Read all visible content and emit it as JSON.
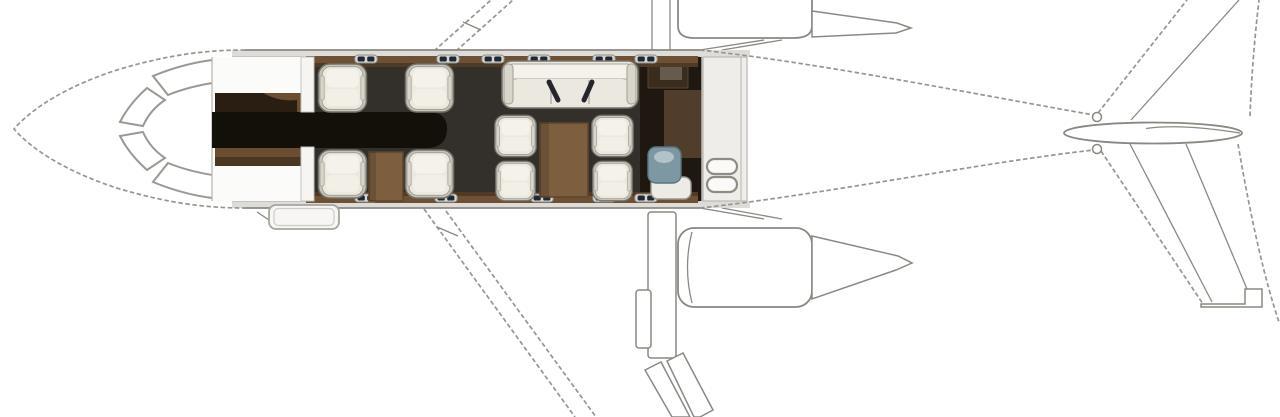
{
  "figure": {
    "kind": "business-jet-cabin-floorplan",
    "view": "top-down",
    "orientation": "nose-left-tail-right"
  },
  "aircraft": {
    "windshield_panels": 4,
    "engines": 2,
    "engine_mount": "rear-fuselage",
    "tail_type": "t-tail",
    "entry_door": "forward lower-edge airstair door",
    "cabin_windows_upper_row": 6,
    "cabin_windows_lower_row": 5,
    "seating": {
      "forward_club_seats": 4,
      "divan_seats": 3,
      "aft_conference_seats": 4,
      "total_passenger_seats": 11,
      "tables": 2
    },
    "zones": [
      "cockpit",
      "forward-entry-and-galley",
      "forward-club-seating",
      "mid-cabin-divan",
      "aft-conference-group",
      "aft-lavatory",
      "rear-baggage-compartment"
    ]
  },
  "colors": {
    "outline_dashed": "#98958f",
    "outline_solid": "#8b8882",
    "wall_band": "#dedcd8",
    "cabin_floor": "#33302b",
    "entry_floor": "#131009",
    "galley_wood": "#6b4e31",
    "galley_wood_dark": "#2a1d12",
    "sill_wood": "#6e5134",
    "table_wood": "#7d5f40",
    "table_wood_dark": "#5e452c",
    "seat_shell": "#c7c4bb",
    "seat_cushion": "#ebe8df",
    "seat_cushion_hi": "#f4f2ea",
    "seat_stroke": "#75726a",
    "divan_fill": "#e9e6dd",
    "belt": "#26252d",
    "window_frame": "#d9d7d2",
    "window_pane": "#1f2836",
    "lav_floor": "#1e1811",
    "lav_panel": "#503d2b",
    "toilet_blue": "#7e98a3",
    "toilet_blue_hi": "#b7c6cc",
    "porcelain": "#edebe6",
    "baggage_fill": "#efede9",
    "baggage_line": "#c2bfba",
    "handle_fill": "#fbfaf8"
  }
}
